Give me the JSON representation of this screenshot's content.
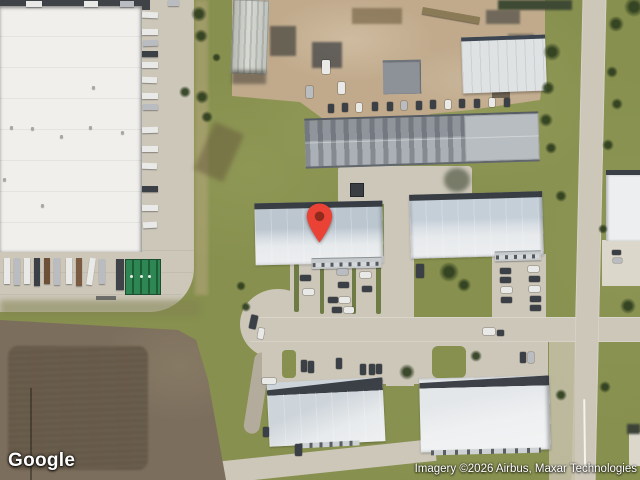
{
  "map": {
    "logo_text": "Google",
    "attribution": "Imagery ©2026 Airbus, Maxar Technologies",
    "marker": {
      "shape": "pin",
      "color": "#EA4335",
      "dot_color": "#8F2A1D"
    }
  },
  "colors": {
    "grass": "#87904e",
    "grass_dark": "#6f7b44",
    "concrete": "#cdc7ba",
    "concrete_light": "#dcd7cb",
    "dirt_field": "#7c6e5d",
    "dirt_field_dark": "#6a5d4c",
    "yard_dirt": "#c1aa8c",
    "roof_white": "#f1efeb",
    "roof_blue_gray": "#bcc6cf",
    "roof_light": "#e7eaec",
    "roof_gray": "#a2a8ad",
    "shadow_dark": "#2d3237",
    "dumpster_green": "#2e8653",
    "marker_red": "#EA4335",
    "marker_dot": "#8F2A1D",
    "car_dark": "#3b3f46",
    "car_white": "#e9e9e7",
    "car_silver": "#b9bcc0"
  }
}
